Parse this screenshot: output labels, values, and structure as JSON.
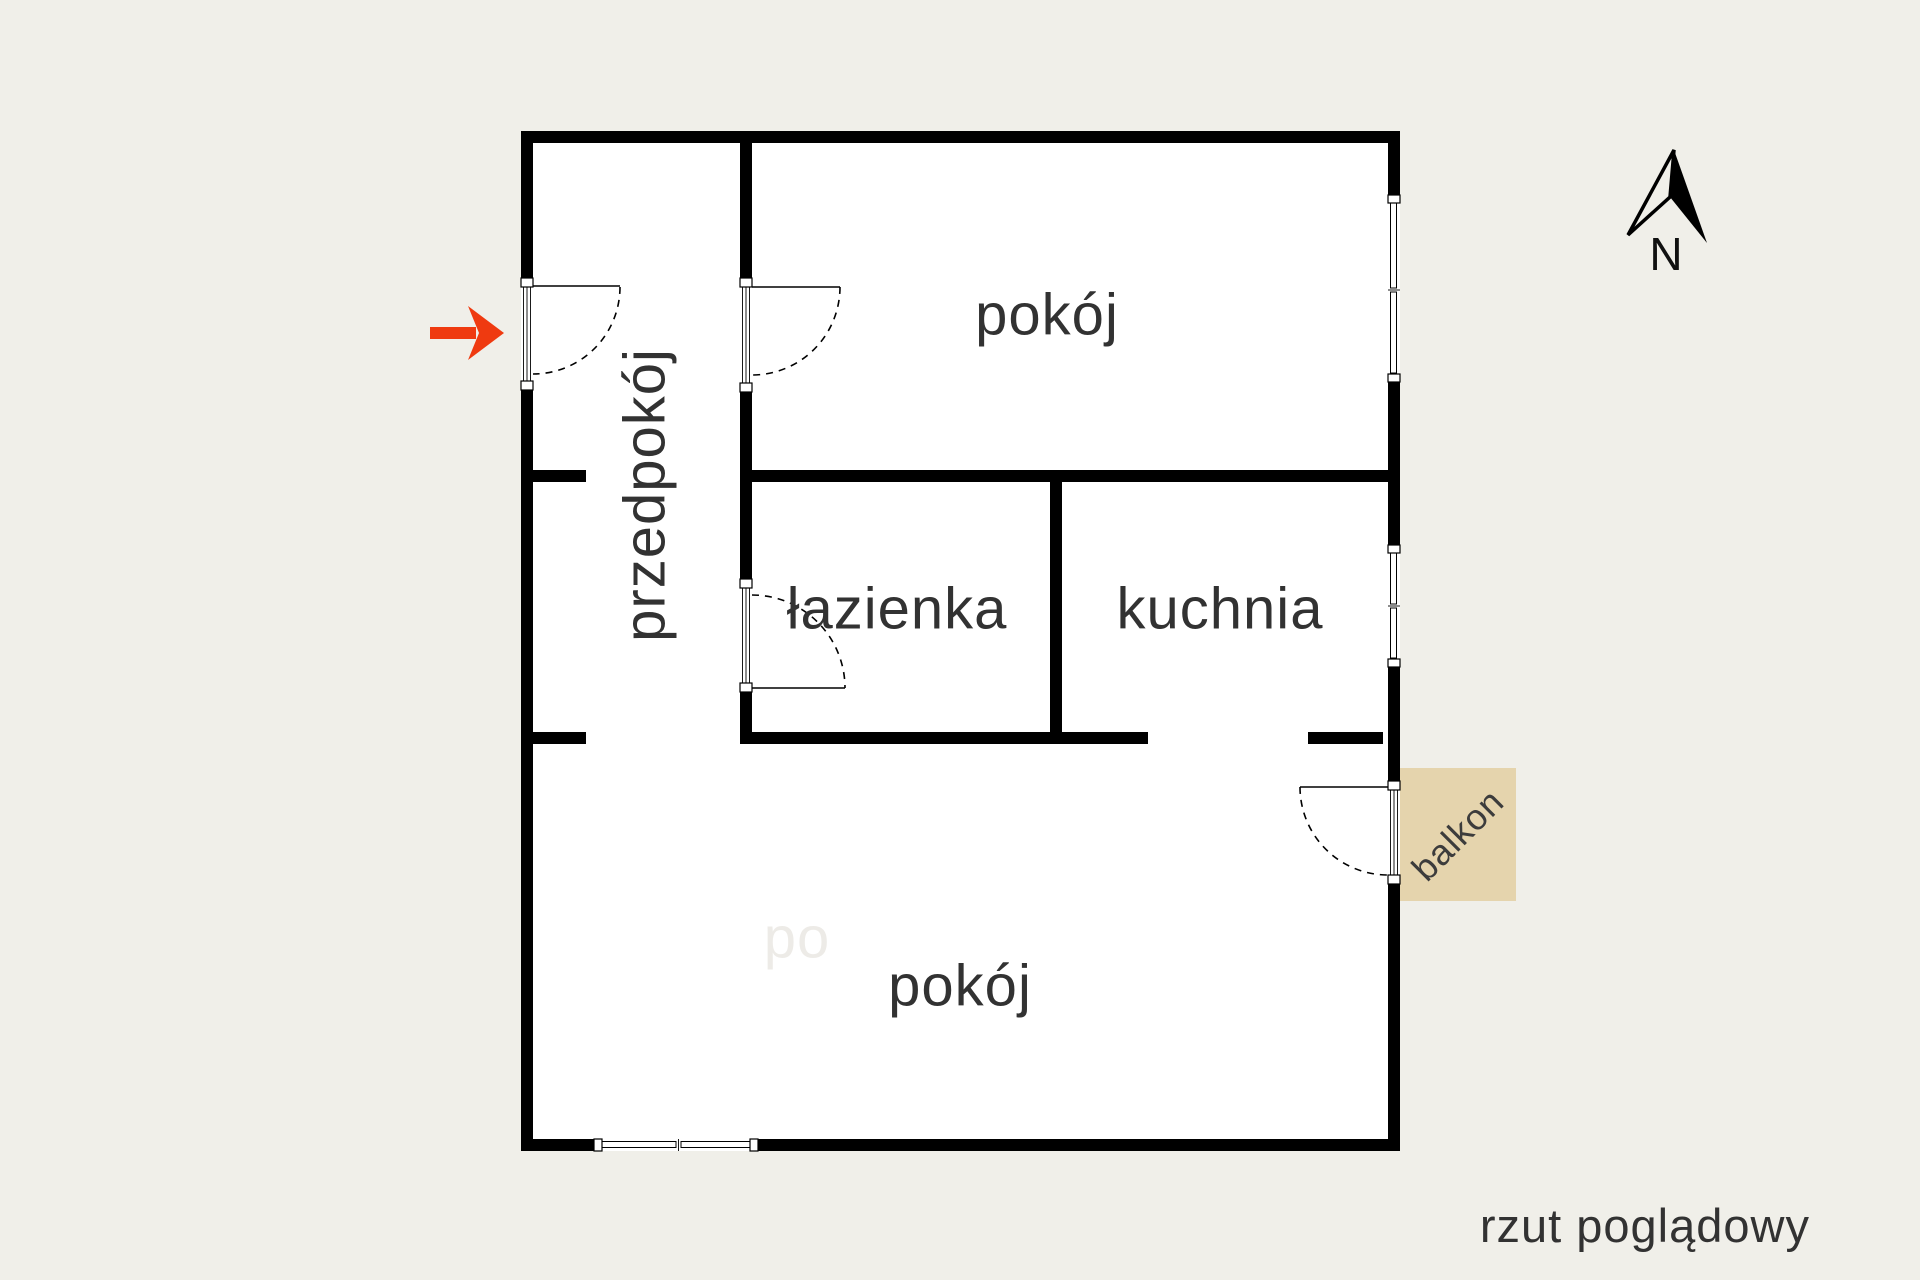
{
  "plan": {
    "rooms": {
      "hallway": "przedpokój",
      "room_top": "pokój",
      "bathroom": "łazienka",
      "kitchen": "kuchnia",
      "room_bottom": "pokój",
      "balcony": "balkon"
    },
    "watermark": "po",
    "caption": "rzut poglądowy",
    "compass_label": "N"
  },
  "colors": {
    "background": "#f0efe9",
    "plan_fill": "#ffffff",
    "wall": "#000000",
    "balcony_fill": "#e5d4ad",
    "arrow": "#ef3a10",
    "label": "#323232",
    "watermark": "#edebe7"
  }
}
